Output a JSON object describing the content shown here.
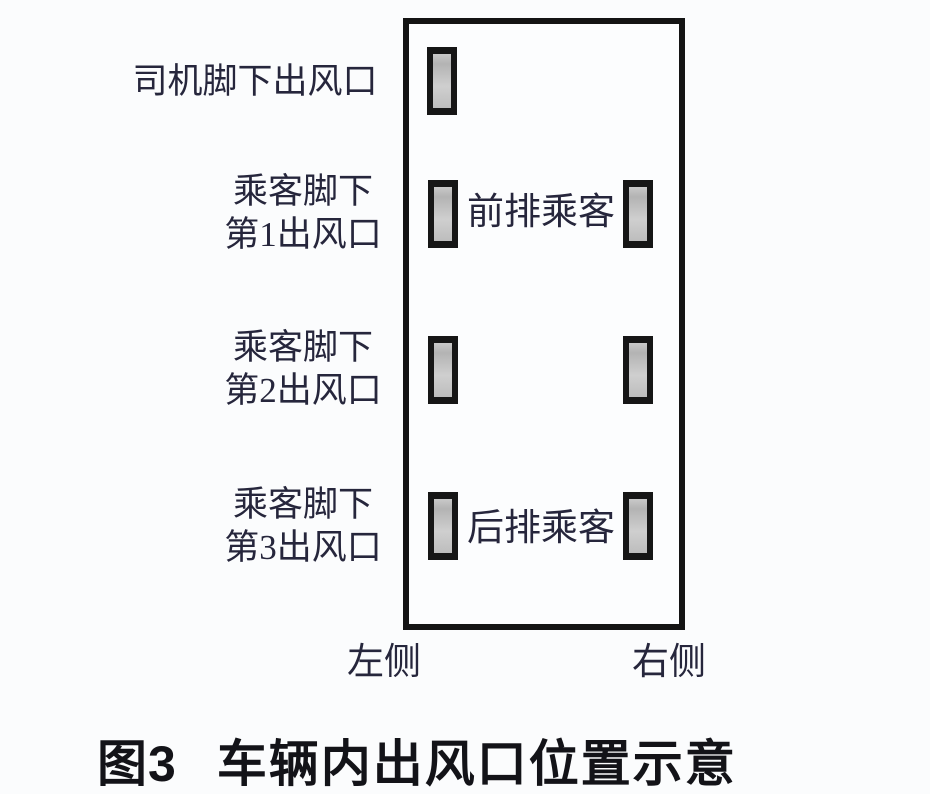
{
  "figure": {
    "caption": {
      "number": "图3",
      "title": "车辆内出风口位置示意"
    }
  },
  "diagram": {
    "outlet_labels": [
      {
        "lines": [
          "司机脚下出风口"
        ]
      },
      {
        "lines": [
          "乘客脚下",
          "第1出风口"
        ]
      },
      {
        "lines": [
          "乘客脚下",
          "第2出风口"
        ]
      },
      {
        "lines": [
          "乘客脚下",
          "第3出风口"
        ]
      }
    ],
    "interior_labels": {
      "front_row": "前排乘客",
      "rear_row": "后排乘客"
    },
    "side_labels": {
      "left": "左侧",
      "right": "右侧"
    },
    "outlets": [
      {
        "row": 1,
        "sides": [
          "left"
        ]
      },
      {
        "row": 2,
        "sides": [
          "left",
          "right"
        ]
      },
      {
        "row": 3,
        "sides": [
          "left",
          "right"
        ]
      },
      {
        "row": 4,
        "sides": [
          "left",
          "right"
        ]
      }
    ],
    "colors": {
      "background": "#fbfcfd",
      "outline_stroke": "#141414",
      "outlet_frame": "#161616",
      "outlet_fill": "#bfbfbf",
      "label_text": "#26263c",
      "caption_text": "#131318"
    }
  }
}
